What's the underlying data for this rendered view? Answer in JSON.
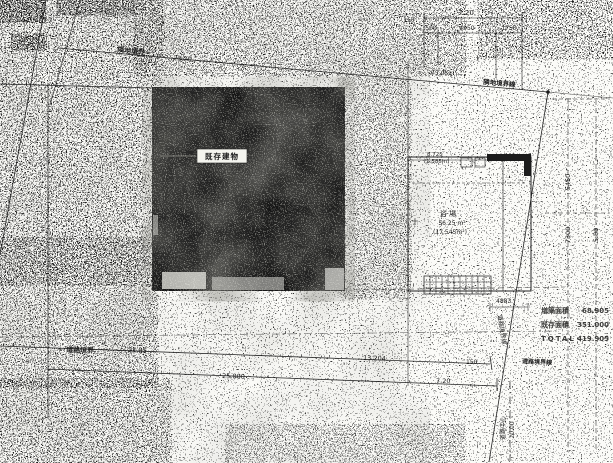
{
  "drawing": {
    "buildings": {
      "existing_label": "既存建物",
      "extension_room": "浴 場",
      "extension_area": "56.25 m²",
      "extension_area_sub": "(17.545m²)",
      "extension_note1": "8.725",
      "extension_note2": "(1.585m)"
    },
    "boundaries": {
      "top_label": "隣地境界",
      "top_length": "23.20",
      "top_line_name": "隣地境界線",
      "road_label": "道路境界",
      "road_length1": "21.85",
      "road_length2": "25.000",
      "right_line_name": "道路境界線",
      "road_line_name2": "道路境界線",
      "road_center_label": "道路中心",
      "road_center_length": "20.00"
    },
    "dimensions": {
      "top_total": "7.20",
      "top_seg1": "500",
      "top_seg2": "4950",
      "top_seg3": "1750",
      "top_side": "150",
      "diagonal": "13.054",
      "road_seg1": "13.204",
      "road_seg2": "150",
      "road_seg3": "7.20",
      "right_seg1": "5450",
      "right_seg2": "7300",
      "right_seg3": "5.80",
      "small_right": "4883"
    },
    "area_table": {
      "rows": [
        {
          "label": "増築面積",
          "value": "68.905"
        },
        {
          "label": "既存面積",
          "value": "351.000"
        },
        {
          "label": "TOTAL",
          "value": "419.905"
        }
      ]
    }
  }
}
